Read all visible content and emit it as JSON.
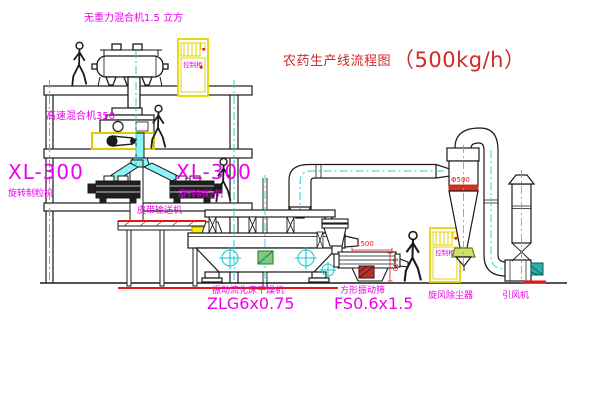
{
  "title": {
    "name": "农药生产线流程图",
    "capacity": "（500kg/h）"
  },
  "equipment": {
    "gravity_mixer": "无重力混合机1.5 立方",
    "speed_mixer": "高速混合机350",
    "granulator_left_model": "XL-300",
    "granulator_left_name": "旋转制粒机",
    "granulator_right_model": "XL-300",
    "granulator_right_name": "旋转制粒机",
    "belt_conveyor": "皮带输送机",
    "dryer_name": "振动流化床干燥机",
    "dryer_model": "ZLG6x0.75",
    "screen_name": "方形振动筛",
    "screen_model": "FS0.6x1.5",
    "cyclone": "旋风除尘器",
    "fan": "引风机"
  },
  "cabinets": {
    "panel_text": "控制柜"
  },
  "dimensions": {
    "screen_length": "1500",
    "screen_height": "540",
    "cyclone_diameter": "Φ500"
  },
  "colors": {
    "label_magenta": "#ee00ee",
    "title_red": "#cf2a2a",
    "line_red": "#e01919",
    "centerline_cyan": "#1ad6d6",
    "cabinet_yellow": "#e3d400",
    "chute_cyan": "#8df3f5"
  }
}
